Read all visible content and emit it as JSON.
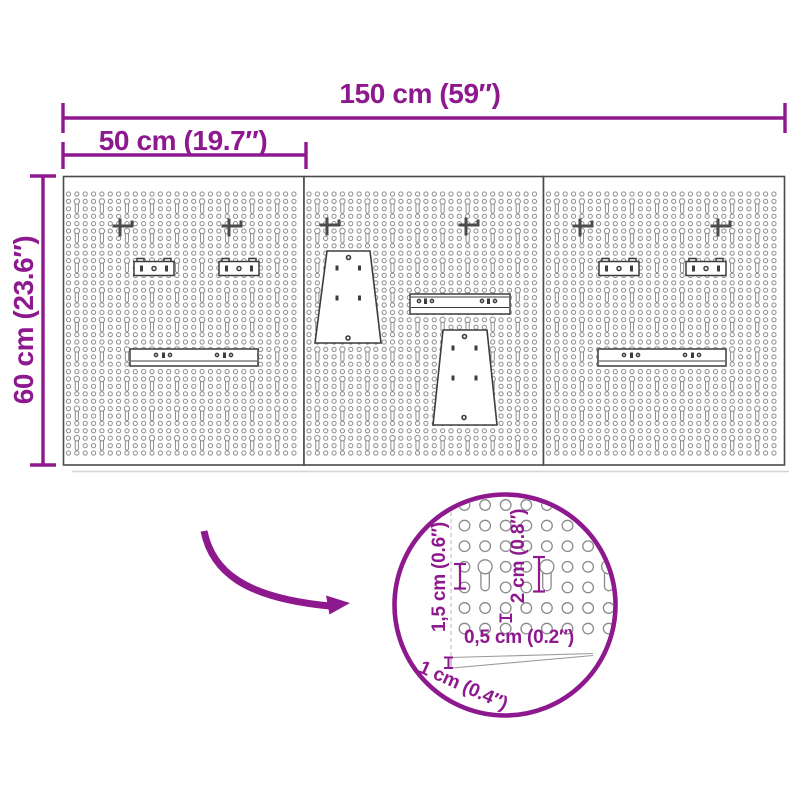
{
  "colors": {
    "accent": "#8E188E",
    "accessory_outline": "#3D3D3D",
    "panel_border": "#4A4A4A",
    "pattern_stroke": "#8C8C8C",
    "background": "#FFFFFF"
  },
  "dimensions": {
    "total_width": "150 cm (59″)",
    "panel_width": "50 cm (19.7″)",
    "height": "60 cm (23.6″)"
  },
  "detail_view": {
    "labels": {
      "slot_length": "1,5 cm (0.6″)",
      "keyhole_length": "2 cm (0.8″)",
      "hole_diameter": "0,5 cm (0.2″)",
      "board_thickness": "1 cm (0.4″)"
    }
  },
  "board": {
    "panel_count": 3,
    "panels": [
      {
        "accessories": [
          "hook",
          "hook",
          "shelf-bracket",
          "shelf-bracket",
          "wall-rail"
        ]
      },
      {
        "accessories": [
          "hook",
          "hook",
          "leg-support",
          "mounting-plate",
          "leg-support"
        ]
      },
      {
        "accessories": [
          "hook",
          "hook",
          "shelf-bracket",
          "shelf-bracket",
          "wall-rail"
        ]
      }
    ]
  }
}
